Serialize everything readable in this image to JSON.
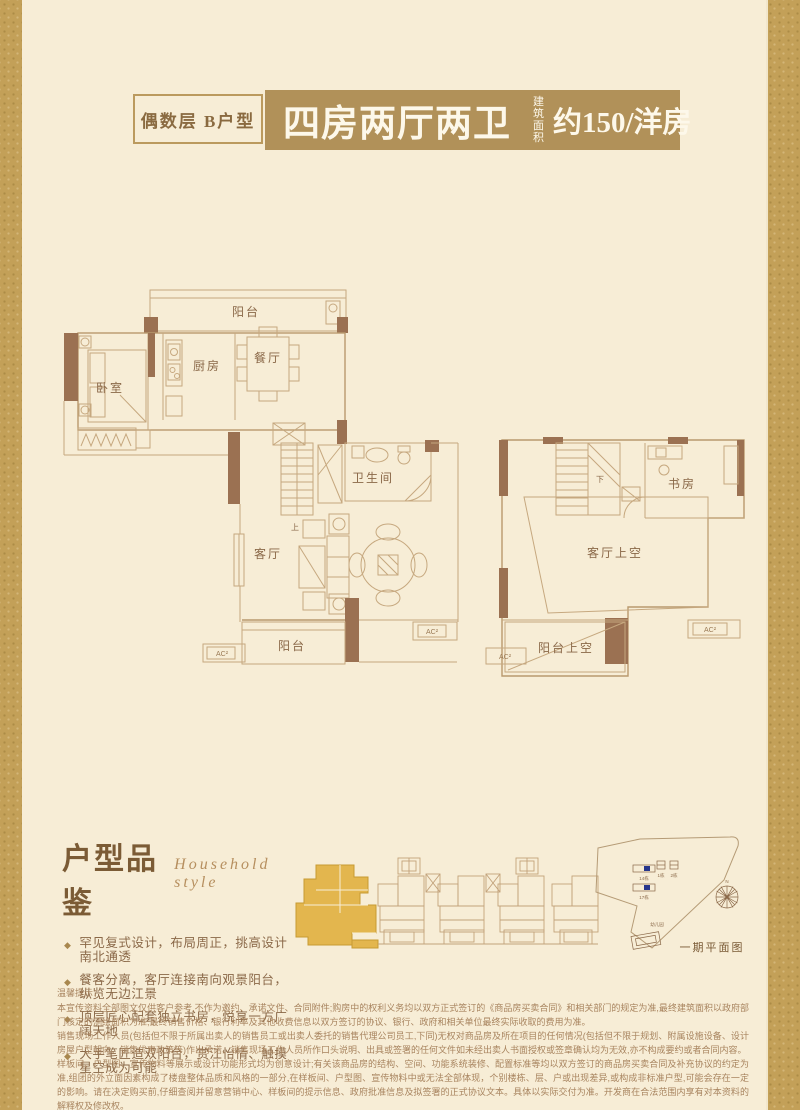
{
  "header": {
    "unit_tag": "偶数层 B户型",
    "title": "四房两厅两卫",
    "area_label_line1": "建筑",
    "area_label_line2": "面积",
    "area_value": "约150/洋房"
  },
  "floorplan": {
    "lower": {
      "balcony_top": "阳台",
      "bedroom": "卧室",
      "kitchen": "厨房",
      "dining": "餐厅",
      "bathroom": "卫生间",
      "stairs_up": "上",
      "living": "客厅",
      "balcony_bottom": "阳台",
      "ac_label": "AC²"
    },
    "upper": {
      "study": "书房",
      "living_void": "客厅上空",
      "balcony_void": "阳台上空",
      "stairs_down": "下",
      "ac_label": "AC²"
    }
  },
  "appreciation": {
    "title": "户型品鉴",
    "subtitle": "Household style",
    "bullet_icon": "◆",
    "bullets": [
      "罕见复式设计，布局周正，挑高设计南北通透",
      "餐客分离，客厅连接南向观景阳台，纵览无边江景",
      "顶层匠心配套独立书房，悦享一方广阔天地",
      "大手笔匠造双阳台，赏江怡情、触摸星空成为可能"
    ]
  },
  "siteplan": {
    "caption": "一期平面图",
    "building_1": "14栋",
    "building_2": "1栋",
    "building_3": "2栋",
    "building_4": "17栋",
    "kindergarten": "幼儿园",
    "north": "N"
  },
  "disclaimer": {
    "title": "温馨提示：",
    "paragraphs": [
      "本宣传资料全部图文仅供客户参考,不作为邀约、承诺文件、合同附件;购房中的权利义务均以双方正式签订的《商品房买卖合同》和相关部门的规定为准,最终建筑面积以政府部门核定的测绘面积为准,最终销售价格、银行利率及其他收费信息以双方签订的协议、银行、政府和相关单位最终实际收取的费用为准。",
      "销售现场工作人员(包括但不限于所属出卖人的销售员工或出卖人委托的销售代理公司员工,下同)无权对商品房及所在项目的任何情况(包括但不限于规划、附属设施设备、设计房屋户型朝向、销售优惠政策等)作出承诺、销售现场工作人员所作口头说明、出具或签署的任何文件如未经出卖人书面授权或签章确认均为无效,亦不构成要约或者合同内容。",
      "样板间、户型图、宣传物料等展示或设计功能形式均为创意设计;有关该商品房的结构、空间、功能系统装修、配置标准等均以双方签订的商品房买卖合同及补充协议的约定为准,组团的外立面因素构成了楼盘整体品质和风格的一部分,在样板间、户型图、宣传物料中或无法全部体现，个别楼栋、层、户或出现差异,或构成非标准户型,可能会存在一定的影响。请在决定购买前,仔细查阅并留意营销中心、样板间的提示信息、政府批准信息及拟签署的正式协议文本。具体以实际交付为准。开发商在合法范围内享有对本资料的解释权及修改权。"
    ]
  },
  "colors": {
    "page_bg": "#f7edd6",
    "border_gold": "#c3a058",
    "banner_gold": "#b19159",
    "wall_brown": "#9b7152",
    "line_tan": "#c6a87f",
    "highlight_gold": "#e3b64e",
    "text_brown": "#8a6848"
  }
}
